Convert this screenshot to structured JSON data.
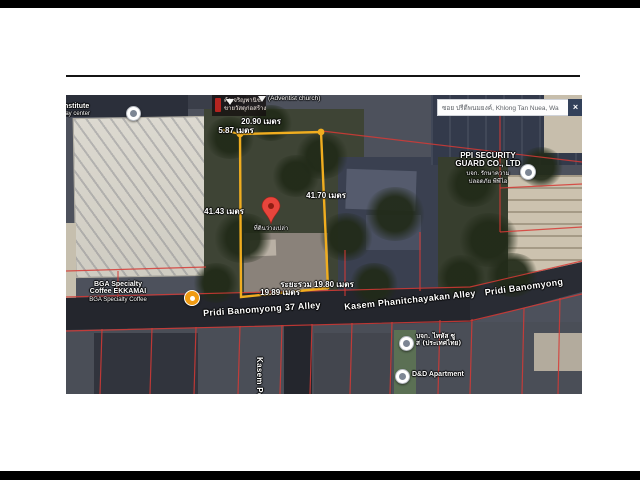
{
  "map": {
    "colors": {
      "plot_outline": "#f0ad1f",
      "cadastral_line": "#d63a35",
      "pin": "#e8453c",
      "coffee_icon": "#f09b13"
    },
    "search_bar": {
      "query": "ซอย ปรีดีพนมยงค์, Khlong Tan Nuea, Wa",
      "close_label": "×"
    },
    "measurements": {
      "top": "20.90 เมตร",
      "top_left": "5.87 เมตร",
      "left": "41.43 เมตร",
      "right": "41.70 เมตร",
      "bottom_total": "ระยะรวม 19.80 เมตร",
      "bottom": "19.89 เมตร"
    },
    "streets": {
      "pridi37": "Pridi Banomyong 37 Alley",
      "kasem": "Kasem Phanitchayakan Alley",
      "pridi": "Pridi Banomyong",
      "kasem_po": "Kasem Po"
    },
    "pois": {
      "institute": {
        "line1": "Institute",
        "line2": "day center"
      },
      "shop": {
        "line1": "ค้าเจริญพานิช",
        "line2": "ขายวัสดุก่อสร้าง"
      },
      "church": "(Adventist church)",
      "ppi": {
        "line1": "PPI SECURITY",
        "line2": "GUARD CO., LTD",
        "line3": "บจก. รักษาความ",
        "line4": "ปลอดภัย พีพีไอ"
      },
      "bga": {
        "line1": "BGA Specialty",
        "line2": "Coffee EKKAMAI",
        "line3": "BGA Specialty Coffee"
      },
      "thai_co": {
        "line1": "บจก. ไทหัส ซู",
        "line2": "ส (ประเทศไทย)"
      },
      "dd": "D&D Apartment",
      "pin_label": "ที่ดินว่างเปล่า"
    }
  }
}
